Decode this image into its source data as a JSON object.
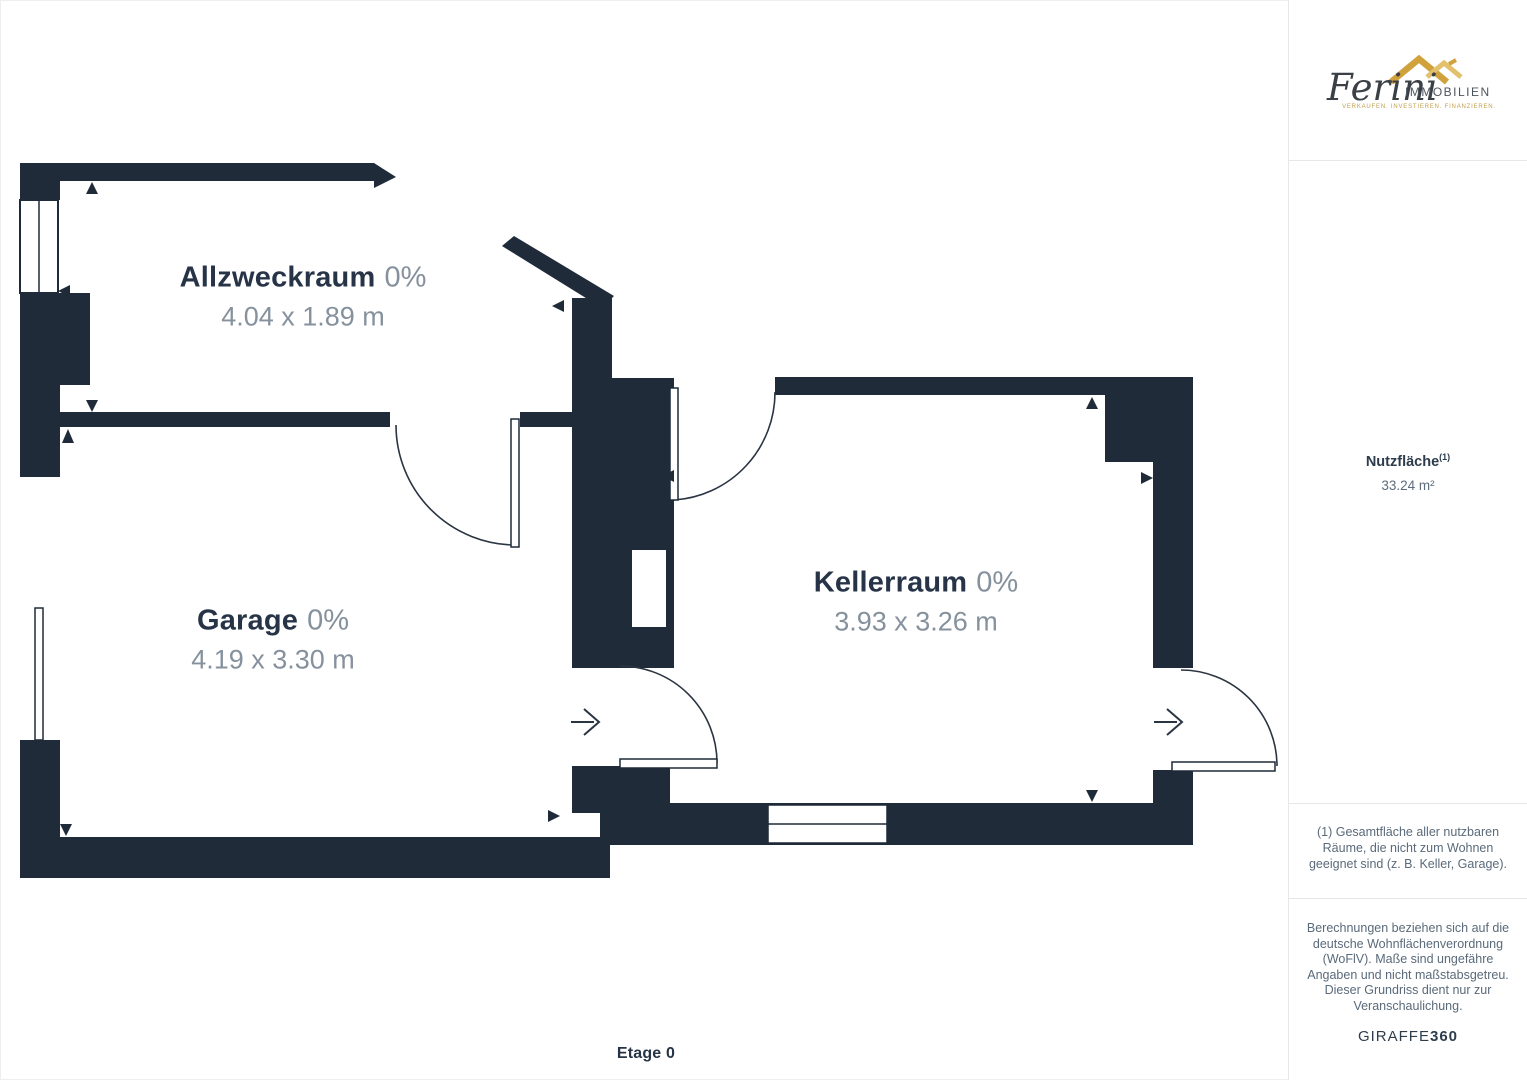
{
  "floor": {
    "label": "Etage 0"
  },
  "rooms": [
    {
      "name": "Allzweckraum",
      "pct": "0%",
      "dims": "4.04 x 1.89 m"
    },
    {
      "name": "Garage",
      "pct": "0%",
      "dims": "4.19 x 3.30 m"
    },
    {
      "name": "Kellerraum",
      "pct": "0%",
      "dims": "3.93 x 3.26 m"
    }
  ],
  "logo": {
    "brand_script": "Ferini",
    "brand_caps": "IMMOBILIEN",
    "tagline": "VERKAUFEN. INVESTIEREN. FINANZIEREN.",
    "roof_icon": "double-roof-icon"
  },
  "sidebar": {
    "area_label": "Nutzfläche",
    "area_marker": "(1)",
    "area_value": "33.24 m²",
    "footnote": "(1) Gesamtfläche aller nutzbaren Räume, die nicht zum Wohnen geeignet sind (z. B. Keller, Garage).",
    "disclaimer": "Berechnungen beziehen sich auf die deutsche Wohnflächenverordnung (WoFlV). Maße sind ungefähre Angaben und nicht maßstabsgetreu. Dieser Grundriss dient nur zur Veranschaulichung.",
    "brand_regular": "GIRAFFE",
    "brand_bold": "360"
  },
  "colors": {
    "wall": "#1F2B39",
    "label_dark": "#273447",
    "label_gray": "#85919D",
    "sidebar_text": "#5A6A7A",
    "divider": "#E5E7E9",
    "logo_gold": "#D0A23E",
    "logo_gold_light": "#E3C06C"
  }
}
